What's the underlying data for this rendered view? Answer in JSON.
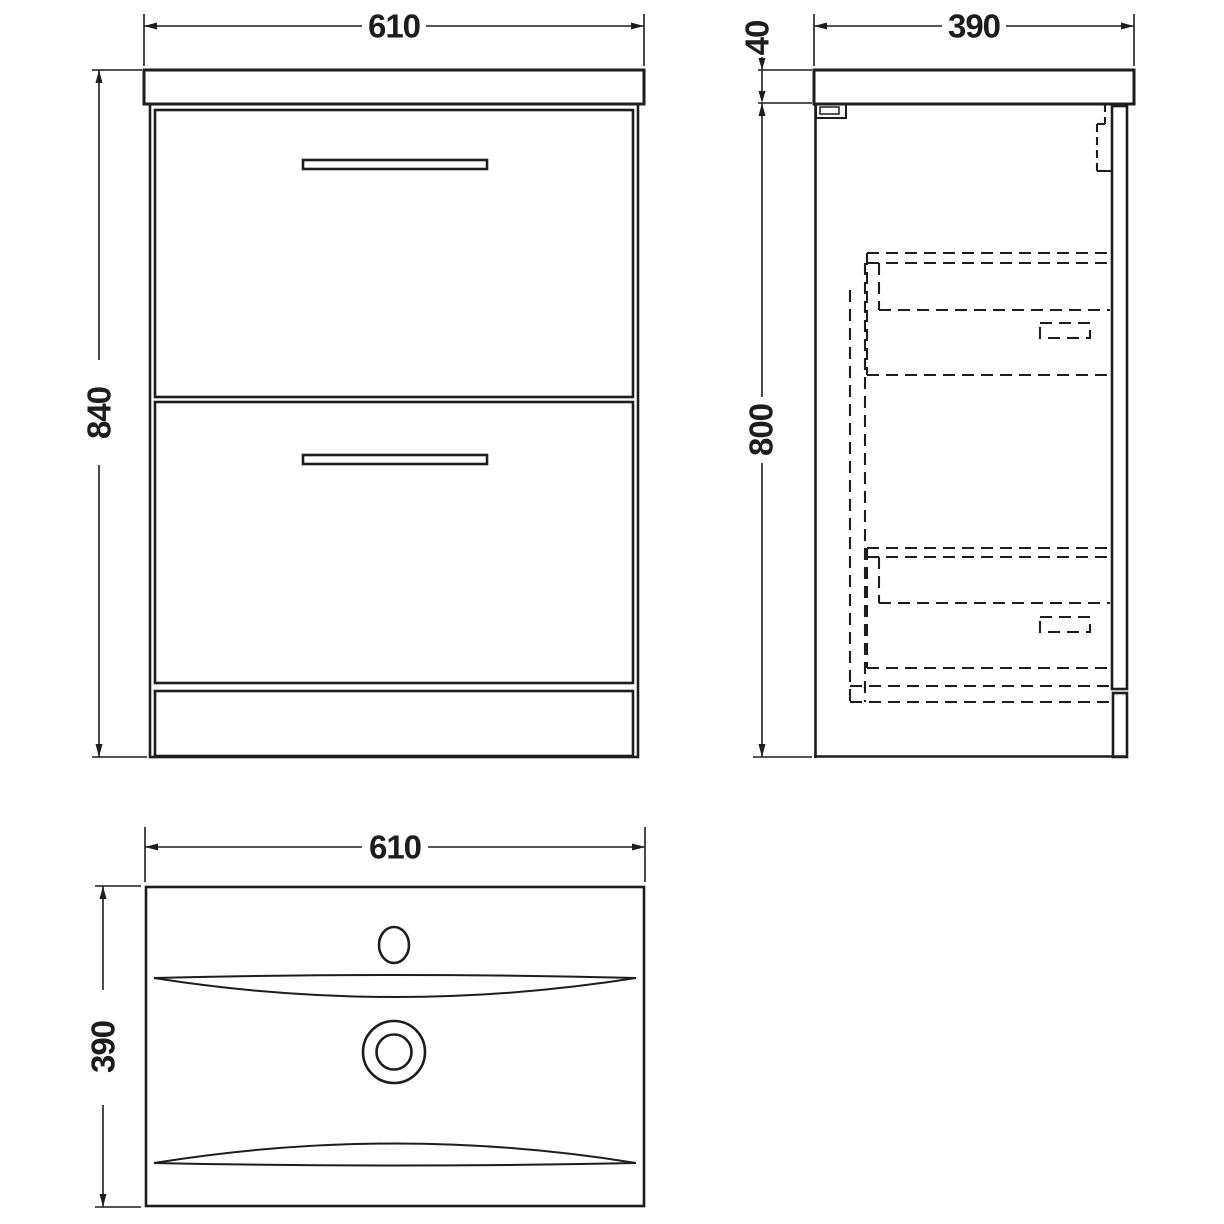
{
  "colors": {
    "line": "#1d1d1d",
    "background": "#ffffff"
  },
  "labels": {
    "front_width": "610",
    "front_height": "840",
    "side_depth": "390",
    "side_worktop_thickness": "40",
    "side_height": "800",
    "plan_width": "610",
    "plan_depth": "390"
  }
}
